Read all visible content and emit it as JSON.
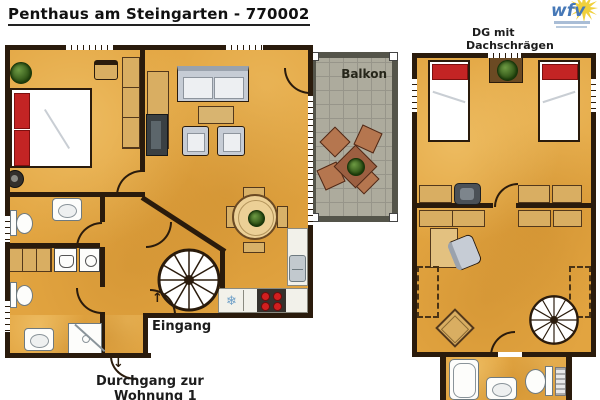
{
  "title": "Penthaus am Steingarten - 770002",
  "logo": {
    "text": "wfv"
  },
  "labels": {
    "balcony": "Balkon",
    "attic_line1": "DG mit",
    "attic_line2": "Dachschrägen",
    "entrance": "Eingang",
    "passage_line1": "Durchgang zur",
    "passage_line2": "Wohnung 1"
  },
  "icons": {
    "snowflake": "❄",
    "entrance_arrow": "↑",
    "passage_arrow": "↓"
  },
  "palette": {
    "floor_orange": "#e2a440",
    "wall_dark": "#2a1b0c",
    "bed_red": "#c32424",
    "sofa_gray": "#c6ccd5",
    "wood_tan": "#d9ae62",
    "balcony_floor": "#adab9d",
    "balcony_frame": "#54544a",
    "stove_red": "#d11f1f",
    "logo_blue": "#4678b7",
    "logo_yellow": "#f0d03c"
  }
}
